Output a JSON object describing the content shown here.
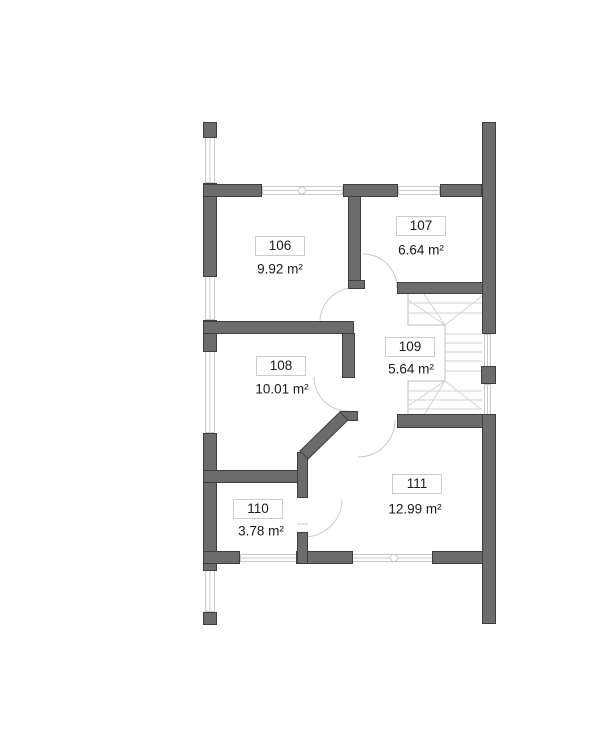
{
  "document": {
    "kind": "floor-plan",
    "floor_label": ""
  },
  "rooms": [
    {
      "number": "106",
      "area": "9.92 m²"
    },
    {
      "number": "107",
      "area": "6.64 m²"
    },
    {
      "number": "108",
      "area": "10.01 m²"
    },
    {
      "number": "109",
      "area": "5.64 m²"
    },
    {
      "number": "110",
      "area": "3.78 m²"
    },
    {
      "number": "111",
      "area": "12.99 m²"
    }
  ],
  "colors": {
    "wall_fill": "#6C6C6C",
    "wall_outline": "#3E3E3E",
    "thin_line": "#C9C9C9",
    "stair_line": "#D2D2D2",
    "label_border": "#CCCCCC",
    "text": "#1A1A1A",
    "background": "#FFFFFF"
  }
}
